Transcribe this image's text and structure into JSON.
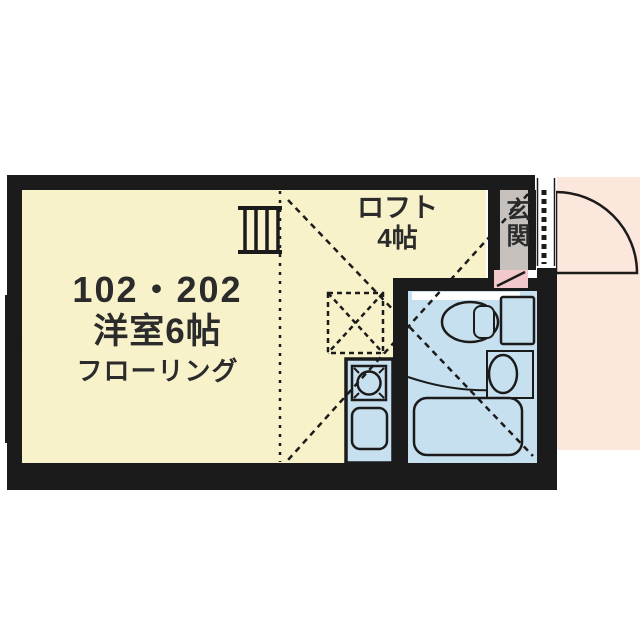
{
  "plan": {
    "unit": {
      "number": "102・202",
      "type": "洋室6帖",
      "floor": "フローリング"
    },
    "loft": {
      "label": "ロフト",
      "size": "4帖"
    },
    "entrance": {
      "label": "玄関"
    }
  },
  "icons": {
    "entry_door": "door-swing-icon",
    "threshold": "door-track-dotted-icon",
    "ladder": "loft-ladder-icon",
    "loft_hatch": "loft-hatch-icon",
    "window": "sliding-window-icon",
    "toilet": "toilet-icon",
    "washbasin": "washbasin-icon",
    "bathtub": "bathtub-icon",
    "stove": "stove-burner-icon",
    "sink": "kitchen-sink-icon"
  },
  "colors": {
    "wall": "#1b1b1b",
    "line": "#1b1b1b",
    "text": "#2b2b2b",
    "floor": "#f8f2cb",
    "fixture_blue": "#c7e0ef",
    "entrance_gray": "#c6c1bc",
    "step_pink": "#f2c8cb",
    "outside_pink": "#fbe7dc"
  }
}
